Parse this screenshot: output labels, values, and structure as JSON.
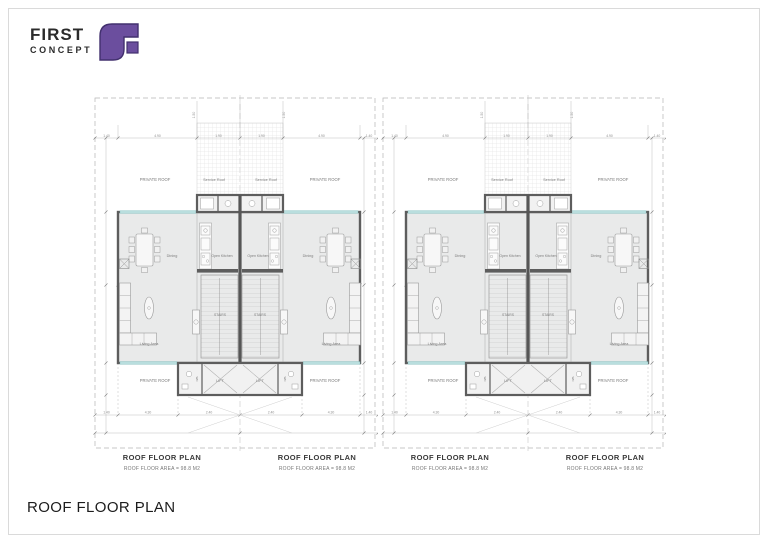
{
  "logo": {
    "line1": "FIRST",
    "line2": "CONCEPT",
    "icon": "first-concept-mark",
    "icon_color": "#6b4e9e"
  },
  "sheet_title": "ROOF FLOOR PLAN",
  "plan_labels": [
    {
      "title": "ROOF FLOOR PLAN",
      "subtitle": "ROOF FLOOR AREA = 98.8 M2"
    },
    {
      "title": "ROOF FLOOR PLAN",
      "subtitle": "ROOF FLOOR AREA = 98.8 M2"
    },
    {
      "title": "ROOF FLOOR PLAN",
      "subtitle": "ROOF FLOOR AREA = 98.8 M2"
    },
    {
      "title": "ROOF FLOOR PLAN",
      "subtitle": "ROOF FLOOR AREA = 98.8 M2"
    }
  ],
  "rooms": {
    "private_roof": "PRIVATE ROOF",
    "service_roof": "Service Roof",
    "dining": "Dining",
    "open_kitchen": "Open Kitchen",
    "living_area": "Living Area",
    "stairs": "STAIRS",
    "lift": "LIFT",
    "wc": "WC"
  },
  "dims": {
    "top": [
      "1.40",
      "4.90",
      "1.90",
      "1.90",
      "4.90",
      "1.40"
    ],
    "bottom": [
      "1.40",
      "4.30",
      "2.40",
      "2.40",
      "4.30",
      "1.40"
    ],
    "upper": [
      "1.50",
      "1.50"
    ]
  },
  "colors": {
    "wall": "#5d5d5d",
    "floor": "#e9eaea",
    "glazing": "#b9dede",
    "boundary": "#b5b5b5",
    "accent": "#6b4e9e"
  }
}
